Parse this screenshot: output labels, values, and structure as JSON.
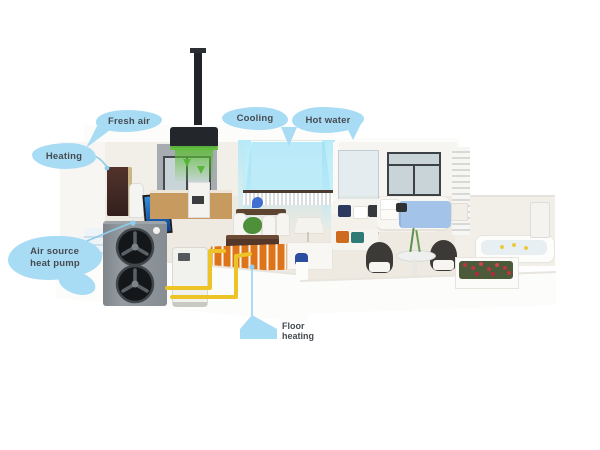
{
  "callouts": {
    "heating": {
      "label": "Heating",
      "target": "indoor-cabinet-unit"
    },
    "fresh_air": {
      "label": "Fresh air",
      "target": "ceiling-ventilation-unit"
    },
    "cooling": {
      "label": "Cooling",
      "target": "ducted-fan-coil"
    },
    "hot_water": {
      "label": "Hot water",
      "target": "bathroom-shower"
    },
    "heat_pump": {
      "label_line1": "Air source",
      "label_line2": "heat pump",
      "target": "outdoor-heat-pump-unit"
    },
    "floor_heating": {
      "label": "Floor heating",
      "target": "floor-heating-coil"
    }
  },
  "colors": {
    "callout_bubble": "#a8dcf5",
    "callout_line": "#8ecdec",
    "callout_text": "#474b50",
    "pipe_yellow": "#ecc427",
    "floor_heating_orange": "#de7419",
    "fresh_air_green": "#58b637",
    "cool_air_blue": "#bfe9f7",
    "background": "#ffffff"
  },
  "icons": [
    "fan-icon",
    "chimney-icon",
    "down-arrow-icon",
    "location-dot-icon"
  ]
}
